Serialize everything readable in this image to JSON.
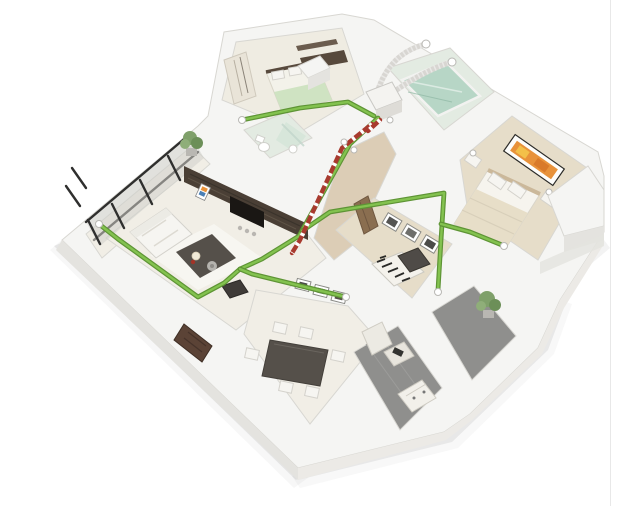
{
  "scene": {
    "type": "3d-isometric-floor-plan-render",
    "subject": "3D cutaway apartment floor plan with green supply ventilation ducts, red exhaust riser and heat-recovery unit",
    "rooms": [
      {
        "id": "left-balcony",
        "label": "balcony with glazing and plant"
      },
      {
        "id": "kids-bedroom",
        "label": "small bedroom with single bed and wardrobe"
      },
      {
        "id": "bathroom",
        "label": "bathroom with teal glass bath"
      },
      {
        "id": "master-bedroom",
        "label": "master bedroom with double bed and orange artwork"
      },
      {
        "id": "toilet",
        "label": "WC with toilet and basin"
      },
      {
        "id": "living-room",
        "label": "living room with sofa, coffee table and dark media wall"
      },
      {
        "id": "hallway",
        "label": "hallway with duct runs"
      },
      {
        "id": "study",
        "label": "study with zebra rug and chaise"
      },
      {
        "id": "dining-room",
        "label": "dining room with table and six chairs"
      },
      {
        "id": "kitchen",
        "label": "kitchen with gray floor and cabinets"
      },
      {
        "id": "terrace",
        "label": "terrace with plant"
      }
    ],
    "systems": [
      {
        "id": "supply-ducts",
        "label": "green supply ventilation ducts"
      },
      {
        "id": "exhaust-duct",
        "label": "red-white striped exhaust duct"
      },
      {
        "id": "ahu-unit",
        "label": "air handling unit"
      },
      {
        "id": "flex-ducts-outdoor",
        "label": "flexible ducts through outer wall"
      }
    ]
  },
  "palette": {
    "background": "#ffffff",
    "frame-line": "#e8e8e8",
    "wall-top": "#f5f5f3",
    "wall-side": "#e4e3df",
    "wall-side-light": "#eceae6",
    "wall-stroke": "#d8d7d2",
    "shadow": "#8a8a88",
    "floor-light": "#f1eee6",
    "floor-cream": "#efece2",
    "floor-beige": "#e6ddc9",
    "floor-wood": "#dccdb6",
    "floor-gray": "#8f8f8d",
    "floor-tile": "#e3ebe2",
    "glass-teal": "#b7d6c6",
    "glass-gray": "#cfcfcb",
    "glazing": "#2f2f2e",
    "wood-dark": "#4a3f35",
    "wood-door": "#8a6e50",
    "door-brown": "#5b4336",
    "supply-pipe": "#83c24f",
    "supply-pipe-dark": "#5e9435",
    "exhaust-pipe": "#a83a2e",
    "duct-flex": "#d8d6d2",
    "plant": "#7fa06a",
    "plant-dark": "#6c8f58",
    "plant-light": "#8fae79",
    "furniture-dark": "#55504a",
    "furniture-white": "#f6f5f1",
    "art-orange": "#e8923a",
    "art-amber": "#f3c049",
    "tv-black": "#1a1714",
    "fabric-green": "#cfe3c2",
    "blanket": "#e7dec8"
  }
}
